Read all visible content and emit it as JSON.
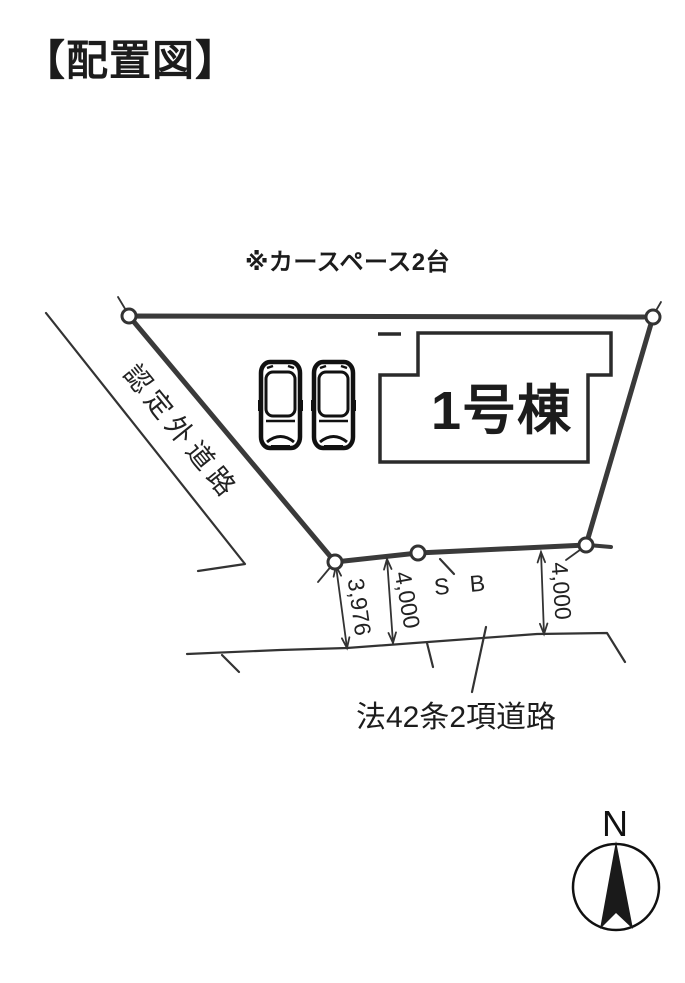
{
  "title": "【配置図】",
  "note": "※カースペース2台",
  "building": {
    "label": "1号棟"
  },
  "roads": {
    "left_label": "認定外道路",
    "bottom_label": "法42条2項道路"
  },
  "setback_label": "S B",
  "dimensions": {
    "left": "3,976",
    "middle": "4,000",
    "right": "4,000"
  },
  "compass": {
    "north_label": "N"
  },
  "icons": {
    "cars": "car-top-view-icon",
    "compass": "compass-north-arrow-icon",
    "vertices": "boundary-vertex-marker"
  },
  "colors": {
    "line": "#333333",
    "text": "#1a1a1a",
    "background": "#ffffff"
  }
}
